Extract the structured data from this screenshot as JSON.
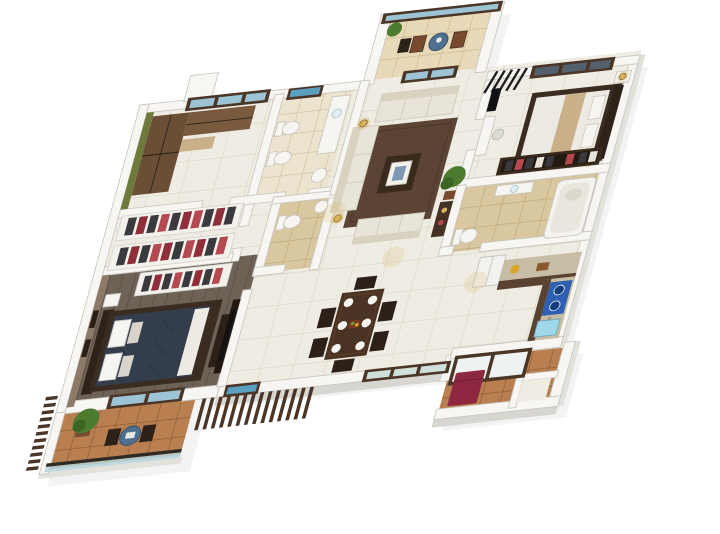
{
  "scene": {
    "kind": "3d-isometric-floor-plan-render",
    "description": "3D rendered top view floor plan of a 3-bedroom apartment on a white background",
    "background": "#ffffff"
  },
  "palette": {
    "wall_top": "#f7f6f2",
    "wall_side": "#d8d6d1",
    "floor_tile": "#efece3",
    "floor_grout": "#e1dccd",
    "balcony_tan": "#e8d9b8",
    "balcony_tan_grout": "#d2c098",
    "bath_floor": "#d9c89f",
    "bath_grout": "#c4ae80",
    "bath1_floor": "#ece4cf",
    "wood_floor": "#6e6156",
    "wood_plank": "#5c5046",
    "terracotta": "#b97f50",
    "terracotta_grout": "#96653b",
    "green_wall": "#6d7a3a",
    "brick_wall": "#8d7a66",
    "wardrobe_brown": "#6b4e36",
    "wardrobe_brown2": "#7a5a3e",
    "dresser_light": "#c9b089",
    "rack_white": "#f2f1ec",
    "sofa": "#e9e4d9",
    "sofa_back": "#d9d2c0",
    "rug": "#5c4434",
    "coffee_table": "#3a2a1c",
    "bed_navy": "#333d4c",
    "bed_frame": "#3a2c20",
    "headboard": "#2e2318",
    "bedding_white": "#eceae2",
    "bed_runner": "#c9b089",
    "pillow": "#f6f5f1",
    "dining_table": "#4a3322",
    "chair_dark": "#2d2019",
    "plate": "#f7f6f2",
    "food_bowl": "#7a3520",
    "counter_marble": "#c7bca4",
    "cabinet_brown": "#5a4230",
    "cooktop_blue": "#2e5fb0",
    "burner_blue": "#173c7a",
    "sink_cyan": "#9fd8e8",
    "fridge_white": "#f2f2f0",
    "window_frame": "#4a3526",
    "window_glass": "#9cc4d4",
    "dark_glass": "#54616c",
    "skylight_blue": "#5b9fc0",
    "glass_rail": "#b5d6dc",
    "slat_wood": "#4a3526",
    "plant_green": "#4c7a2e",
    "plant_dark": "#3c6423",
    "pot_brown": "#7a4a2e",
    "lamp_gold": "#d9b25a",
    "maroon_item": "#8e2740",
    "tv_black": "#121215",
    "bistro_table": "#4f6f8f",
    "clothes_dark": "#3a3a3e",
    "clothes_maroon": "#8e2f3a",
    "clothes_red": "#b6494f",
    "clothes_white": "#e8e4da",
    "tub_white": "#f4f3ef",
    "louver_black": "#1e1e1e"
  },
  "rooms": [
    {
      "id": "bedroom-green",
      "label": "bedroom with green accent wall, brown wardrobes and window"
    },
    {
      "id": "bathroom-shared",
      "label": "bathroom with two white fixtures, vanity and round basin"
    },
    {
      "id": "walk-in-wardrobe",
      "label": "two open clothes racks with dark and red garments"
    },
    {
      "id": "master-bedroom",
      "label": "master bedroom with navy bed, dark wood floor, brick wall, TV unit"
    },
    {
      "id": "master-balcony",
      "label": "terracotta balcony with plant, two chairs, round table, glass railing and wood slats"
    },
    {
      "id": "living-room",
      "label": "living room with cream sofas, brown rug, coffee table and floor lamps"
    },
    {
      "id": "living-balcony",
      "label": "glazed balcony with cafe table, two chairs and plant"
    },
    {
      "id": "toilet-center",
      "label": "small toilet room with basin"
    },
    {
      "id": "dining-area",
      "label": "dark wood dining table with six chairs and white plates"
    },
    {
      "id": "bedroom-right",
      "label": "bedroom with beige bed, desk, chair and open sliding wardrobe"
    },
    {
      "id": "bathroom-right",
      "label": "bathroom with toilet, vanity and bathtub"
    },
    {
      "id": "kitchen",
      "label": "L-shaped kitchen with marble counters, blue cooktop, cyan sink, fridge"
    },
    {
      "id": "utility-balcony",
      "label": "service balcony with glazed brown-framed panels and maroon seat"
    }
  ]
}
